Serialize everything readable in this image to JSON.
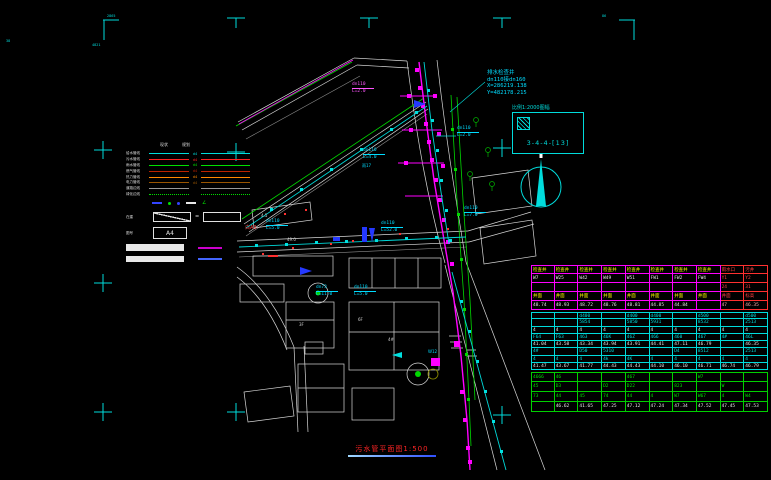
{
  "colors": {
    "cyan": "#00dcdc",
    "magenta": "#ff00ff",
    "green": "#00d800",
    "red": "#ff3030",
    "yellow": "#ffff00",
    "white": "#d8d8d8",
    "blue": "#2438ff"
  },
  "frame": {
    "tl": "2865",
    "tl2": "4821",
    "tr": "86",
    "left": "38"
  },
  "annotation": {
    "lines": [
      "排水检查井",
      "dn110接dn160",
      "X=286219.138",
      "Y=482178.215"
    ]
  },
  "sheet_box": {
    "label": "比例1:2000图幅",
    "number": "3-4-4-[13]"
  },
  "title": {
    "text": "污水管平面图1:500"
  },
  "legend": {
    "col_labels": [
      "现状",
      "规划"
    ],
    "rows": [
      {
        "label": "给水管线",
        "color": "#00dcdc",
        "dash": "solid",
        "tag": "d4"
      },
      {
        "label": "污水管线",
        "color": "#ff2222",
        "dash": "solid",
        "tag": "d4"
      },
      {
        "label": "雨水管线",
        "color": "#00e000",
        "dash": "solid",
        "tag": "d4"
      },
      {
        "label": "燃气管线",
        "color": "#bb2200",
        "dash": "solid",
        "tag": "d4"
      },
      {
        "label": "热力管线",
        "color": "#ff8800",
        "dash": "solid",
        "tag": "d4"
      },
      {
        "label": "电力管线",
        "color": "#995500",
        "dash": "solid",
        "tag": "d4"
      },
      {
        "label": "道路边线",
        "color": "#999999",
        "dash": "solid",
        "tag": ""
      },
      {
        "label": "绿化边线",
        "color": "#00e000",
        "dash": "dotted",
        "tag": ""
      }
    ],
    "symbols": [
      {
        "type": "dash",
        "color": "#3344ff"
      },
      {
        "type": "dot",
        "color": "#00e000"
      },
      {
        "type": "dot",
        "color": "#3344ff"
      },
      {
        "type": "dash",
        "color": "#e8e8e8"
      },
      {
        "type": "angle",
        "color": "#00e000"
      }
    ],
    "box_label": "在建",
    "a4_label": "图号",
    "a4_text": "A4",
    "bars": [
      {
        "h": 7,
        "line_color": "#cc00cc"
      },
      {
        "h": 6,
        "line_color": "#4466ff"
      }
    ]
  },
  "pipe_labels": [
    {
      "x": 352,
      "y": 82,
      "line1": "dn110",
      "line2": "L=2.0",
      "color": "#ff55ff"
    },
    {
      "x": 457,
      "y": 126,
      "line1": "dn110",
      "line2": "L=2.0",
      "color": "#00dcff"
    },
    {
      "x": 363,
      "y": 148,
      "line1": "dn110",
      "line2": "L=4.0",
      "color": "#00dcff"
    },
    {
      "x": 266,
      "y": 219,
      "line1": "dn110",
      "line2": "L=5.0",
      "color": "#00dcff"
    },
    {
      "x": 381,
      "y": 221,
      "line1": "dn110",
      "line2": "L=52.0",
      "color": "#00dcff"
    },
    {
      "x": 316,
      "y": 285,
      "line1": "dn73",
      "line2": "L=11.0",
      "color": "#00dcff"
    },
    {
      "x": 354,
      "y": 285,
      "line1": "dn110",
      "line2": "L=5.0",
      "color": "#00dcff"
    },
    {
      "x": 464,
      "y": 206,
      "line1": "dn110",
      "line2": "L=7.0",
      "color": "#00dcff"
    }
  ],
  "misc_texts": [
    {
      "t": "白A3",
      "x": 245,
      "y": 226,
      "c": "#ff4545",
      "s": 5
    },
    {
      "t": "4.5",
      "x": 261,
      "y": 214,
      "c": "#cfcfcf",
      "s": 4
    },
    {
      "t": "49.0",
      "x": 287,
      "y": 238,
      "c": "#cfcfcf",
      "s": 4
    },
    {
      "t": "3F",
      "x": 299,
      "y": 323,
      "c": "#cfcfcf",
      "s": 4
    },
    {
      "t": "6F",
      "x": 358,
      "y": 318,
      "c": "#cfcfcf",
      "s": 4
    },
    {
      "t": "4#",
      "x": 388,
      "y": 338,
      "c": "#cfcfcf",
      "s": 4
    },
    {
      "t": "雨17",
      "x": 362,
      "y": 164,
      "c": "#00dcff",
      "s": 4
    },
    {
      "t": "W12",
      "x": 428,
      "y": 350,
      "c": "#00dcff",
      "s": 4
    }
  ],
  "table": {
    "col_count": 10,
    "sections": [
      {
        "border": "#ff00ff",
        "alt_border": "#ff3030",
        "alt_cols": [
          8,
          9
        ],
        "row_h": 9,
        "rows": [
          {
            "color": "#ffff00",
            "alt_color": "#ff4040",
            "cells": [
              "检查井",
              "检查井",
              "检查井",
              "检查井",
              "检查井",
              "检查井",
              "检查井",
              "检查井",
              "雨水口",
              "污井"
            ]
          },
          {
            "color": "#e8e8e8",
            "alt_color": "#ff4040",
            "cells": [
              "W7",
              "W25",
              "W42",
              "W49",
              "W51",
              "FW1",
              "FW2",
              "FW4",
              "Y1",
              "Y2"
            ]
          },
          {
            "color": "#e8e8e8",
            "alt_color": "#ff4040",
            "cells": [
              "",
              "",
              "",
              "",
              "",
              "",
              "",
              "",
              "24",
              "31"
            ]
          },
          {
            "color": "#ffff00",
            "alt_color": "#ff4040",
            "cells": [
              "井面",
              "井面",
              "井面",
              "井面",
              "井面",
              "井面",
              "井面",
              "井面",
              "井面",
              "标高"
            ]
          },
          {
            "color": "#e8e8e8",
            "alt_color": "#ffb0b0",
            "cells": [
              "48.74",
              "48.93",
              "48.72",
              "48.76",
              "48.81",
              "44.85",
              "44.84",
              "",
              "47",
              "46.35"
            ]
          }
        ]
      },
      {
        "border": "#00dcdc",
        "row_h": 7.3,
        "rows": [
          {
            "color": "#00dcdc",
            "cells": [
              "",
              "",
              "d400",
              "",
              "d400",
              "d400",
              "",
              "d500",
              "",
              "d500"
            ]
          },
          {
            "color": "#00dcdc",
            "cells": [
              "",
              "",
              "5854",
              "",
              "5850",
              "5931",
              "",
              "8532",
              "",
              "2513"
            ]
          },
          {
            "color": "#e8e8e8",
            "cells": [
              "4",
              "4",
              "4",
              "4",
              "4",
              "4",
              "4",
              "4",
              "4",
              "4"
            ]
          },
          {
            "color": "#00dcdc",
            "cells": [
              "F64",
              "F63",
              "463",
              "46K",
              "46Z",
              "466",
              "460",
              "467",
              "4#",
              "46L"
            ]
          },
          {
            "color": "#e8e8e8",
            "cells": [
              "41.04",
              "43.58",
              "43.34",
              "43.94",
              "43.91",
              "44.41",
              "47.11",
              "46.79",
              "",
              "46.35"
            ]
          },
          {
            "color": "#00dcdc",
            "cells": [
              "4#",
              "",
              "D50",
              "5310",
              "",
              "",
              "D4",
              "8512",
              "",
              "2513"
            ]
          },
          {
            "color": "#00dcdc",
            "cells": [
              "4",
              "4",
              "4",
              "4k",
              "4K",
              "4",
              "4",
              "4",
              "4",
              "4"
            ]
          },
          {
            "color": "#e8e8e8",
            "cells": [
              "41.47",
              "43.67",
              "41.77",
              "44.43",
              "44.43",
              "44.10",
              "46.10",
              "46.71",
              "46.74",
              "46.79"
            ]
          }
        ]
      },
      {
        "border": "#00d000",
        "row_h": 10,
        "rows": [
          {
            "color": "#00e000",
            "cells": [
              "4666",
              "46",
              "",
              "",
              "467",
              "",
              "",
              "W7",
              "",
              ""
            ]
          },
          {
            "color": "#00e000",
            "cells": [
              "45",
              "D3",
              "",
              "D2",
              "D22",
              "",
              "823",
              "",
              "W",
              ""
            ]
          },
          {
            "color": "#00e000",
            "cells": [
              "73",
              "44",
              "45",
              "74",
              "44",
              "4",
              "W7",
              "W67",
              "4",
              "W4"
            ]
          },
          {
            "color": "#e8e8e8",
            "cells": [
              "",
              "46.62",
              "41.65",
              "47.25",
              "47.12",
              "47.24",
              "47.34",
              "47.52",
              "47.45",
              "47.53"
            ]
          }
        ]
      }
    ]
  }
}
